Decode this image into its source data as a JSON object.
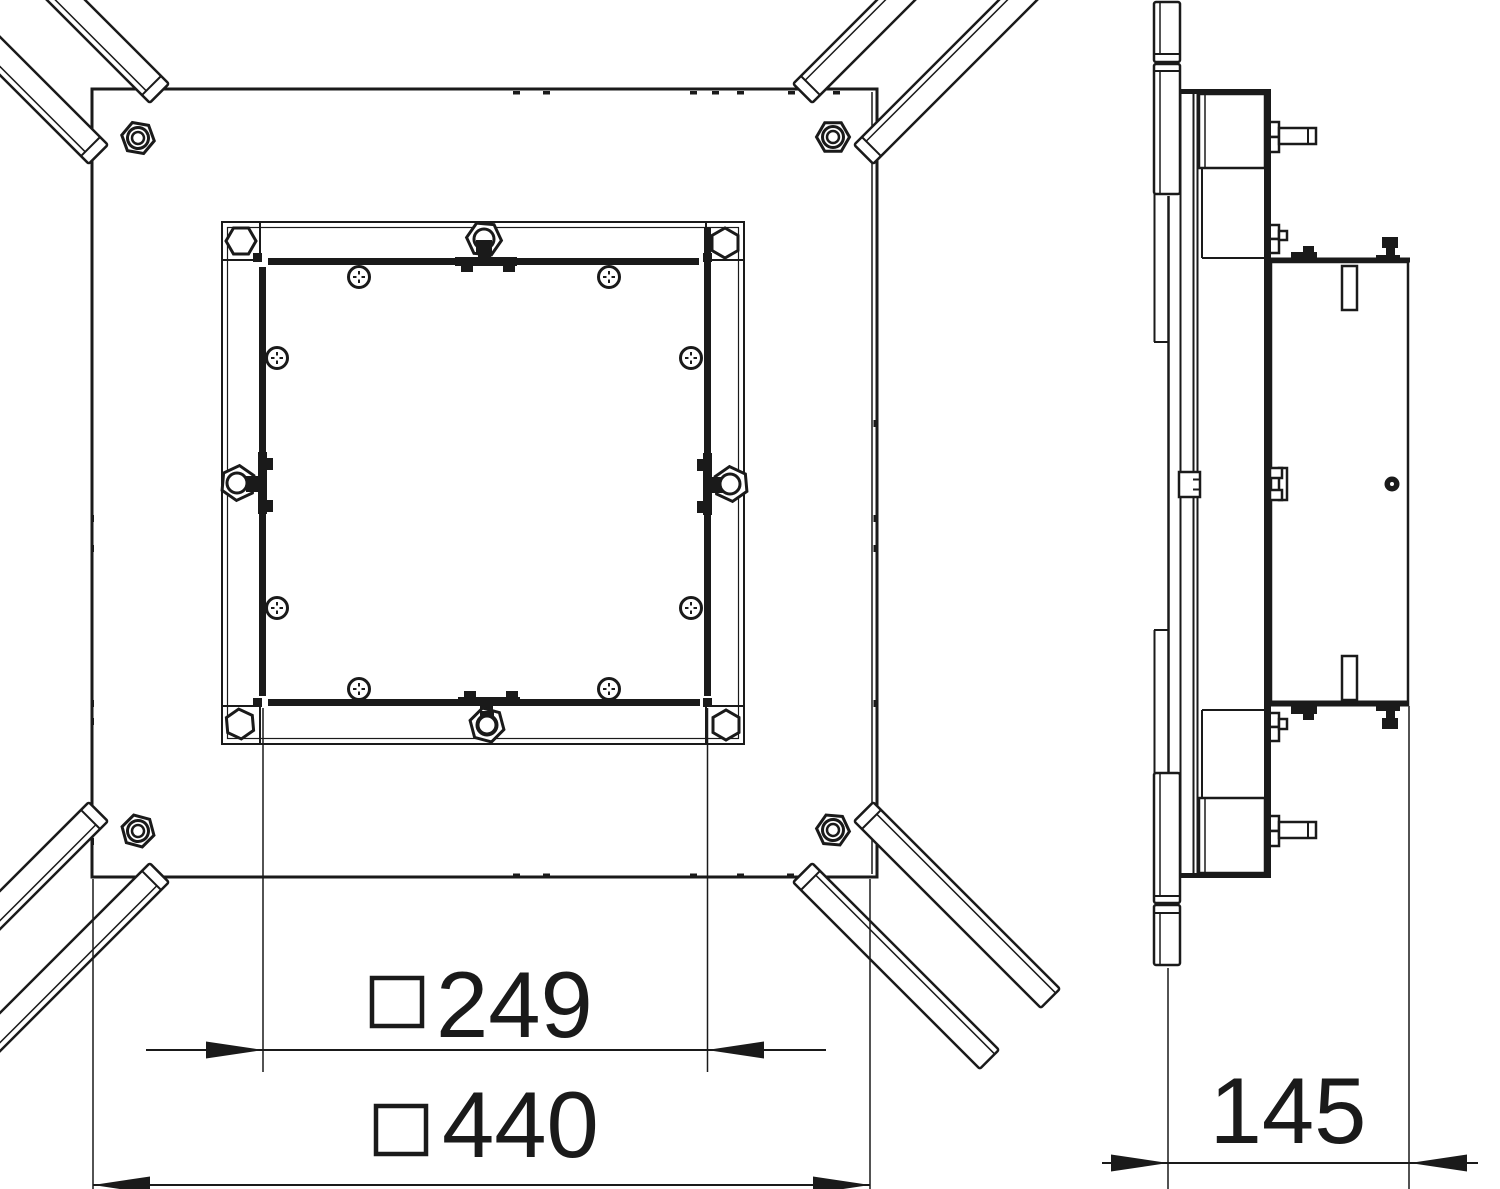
{
  "meta": {
    "kind": "technical-dimension-drawing",
    "views": [
      "plan-view",
      "side-view"
    ],
    "subject": "square floor-box / junction-box with corner conduit stubs and inner mounting frame"
  },
  "colors": {
    "line": "#1a1a1a",
    "background": "#ffffff"
  },
  "dimensions": {
    "inner_width": {
      "symbol": "□",
      "value": "249"
    },
    "outer_width": {
      "symbol": "□",
      "value": "440"
    },
    "depth": {
      "value": "145"
    }
  }
}
